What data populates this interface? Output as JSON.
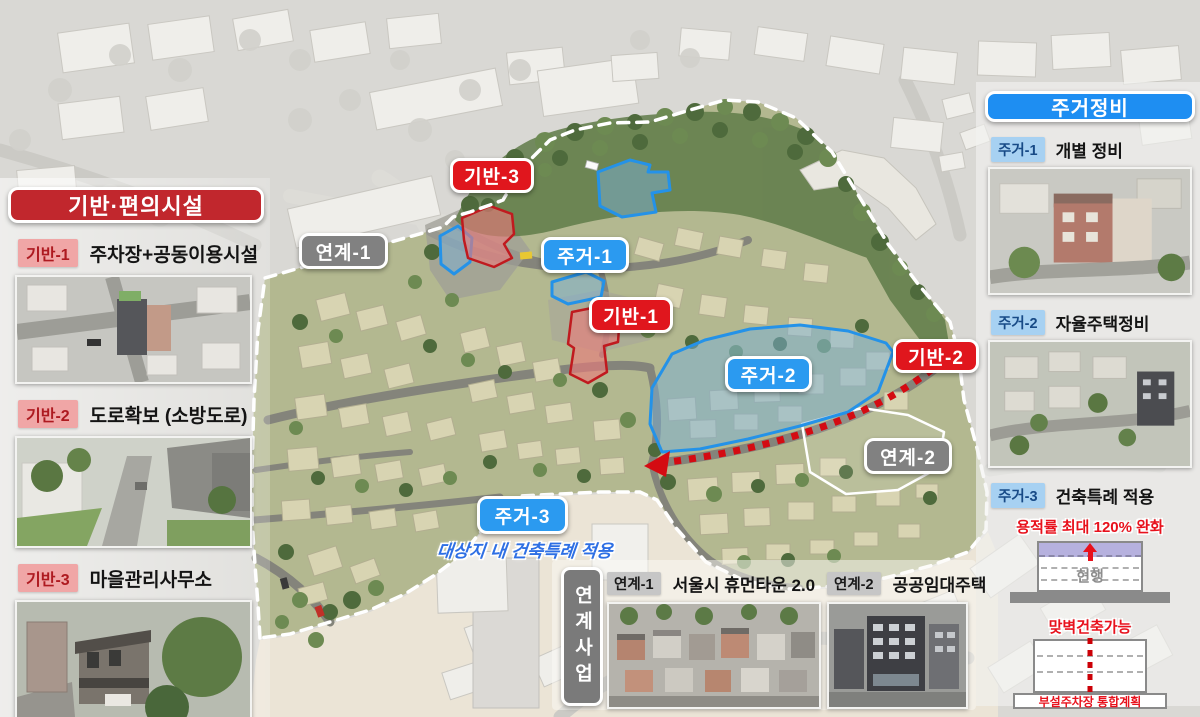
{
  "colors": {
    "panel_red": "#c1272d",
    "panel_blue": "#1e8ef2",
    "map_label_red": "#e0161d",
    "map_label_blue": "#2b9af0",
    "map_label_gray": "#818181",
    "badge_pink_bg": "#f0a6a6",
    "badge_pink_text": "#ae1a20",
    "badge_blue_bg": "#a7d1f2",
    "badge_blue_text": "#174a86",
    "badge_gray_bg": "#c6c6c6",
    "accent_red_text": "#e8111c",
    "annotation_blue": "#2e6fe4",
    "zone_stroke_blue": "#2492e8",
    "zone_stroke_red": "#c01a1f",
    "dotted_route_red": "#d40b12"
  },
  "infra_panel": {
    "title": "기반·편의시설",
    "items": [
      {
        "badge": "기반-1",
        "label": "주차장+공동이용시설"
      },
      {
        "badge": "기반-2",
        "label": "도로확보 (소방도로)"
      },
      {
        "badge": "기반-3",
        "label": "마을관리사무소"
      }
    ]
  },
  "housing_panel": {
    "title": "주거정비",
    "items": [
      {
        "badge": "주거-1",
        "label": "개별 정비"
      },
      {
        "badge": "주거-2",
        "label": "자율주택정비"
      },
      {
        "badge": "주거-3",
        "label": "건축특례 적용"
      }
    ],
    "far_caption": "용적률 최대 120% 완화",
    "current_building_label": "현행",
    "wall_caption": "맞벽건축가능",
    "parking_caption": "부설주차장 통합계획"
  },
  "linked_panel": {
    "vertical_title": "연계사업",
    "items": [
      {
        "badge": "연계-1",
        "label": "서울시 휴먼타운 2.0"
      },
      {
        "badge": "연계-2",
        "label": "공공임대주택"
      }
    ]
  },
  "map": {
    "labels": {
      "giban1": "기반-1",
      "giban2": "기반-2",
      "giban3": "기반-3",
      "jugeo1": "주거-1",
      "jugeo2": "주거-2",
      "jugeo3": "주거-3",
      "yeongye1": "연계-1",
      "yeongye2": "연계-2"
    },
    "annotation": "대상지 내 건축특례 적용"
  }
}
